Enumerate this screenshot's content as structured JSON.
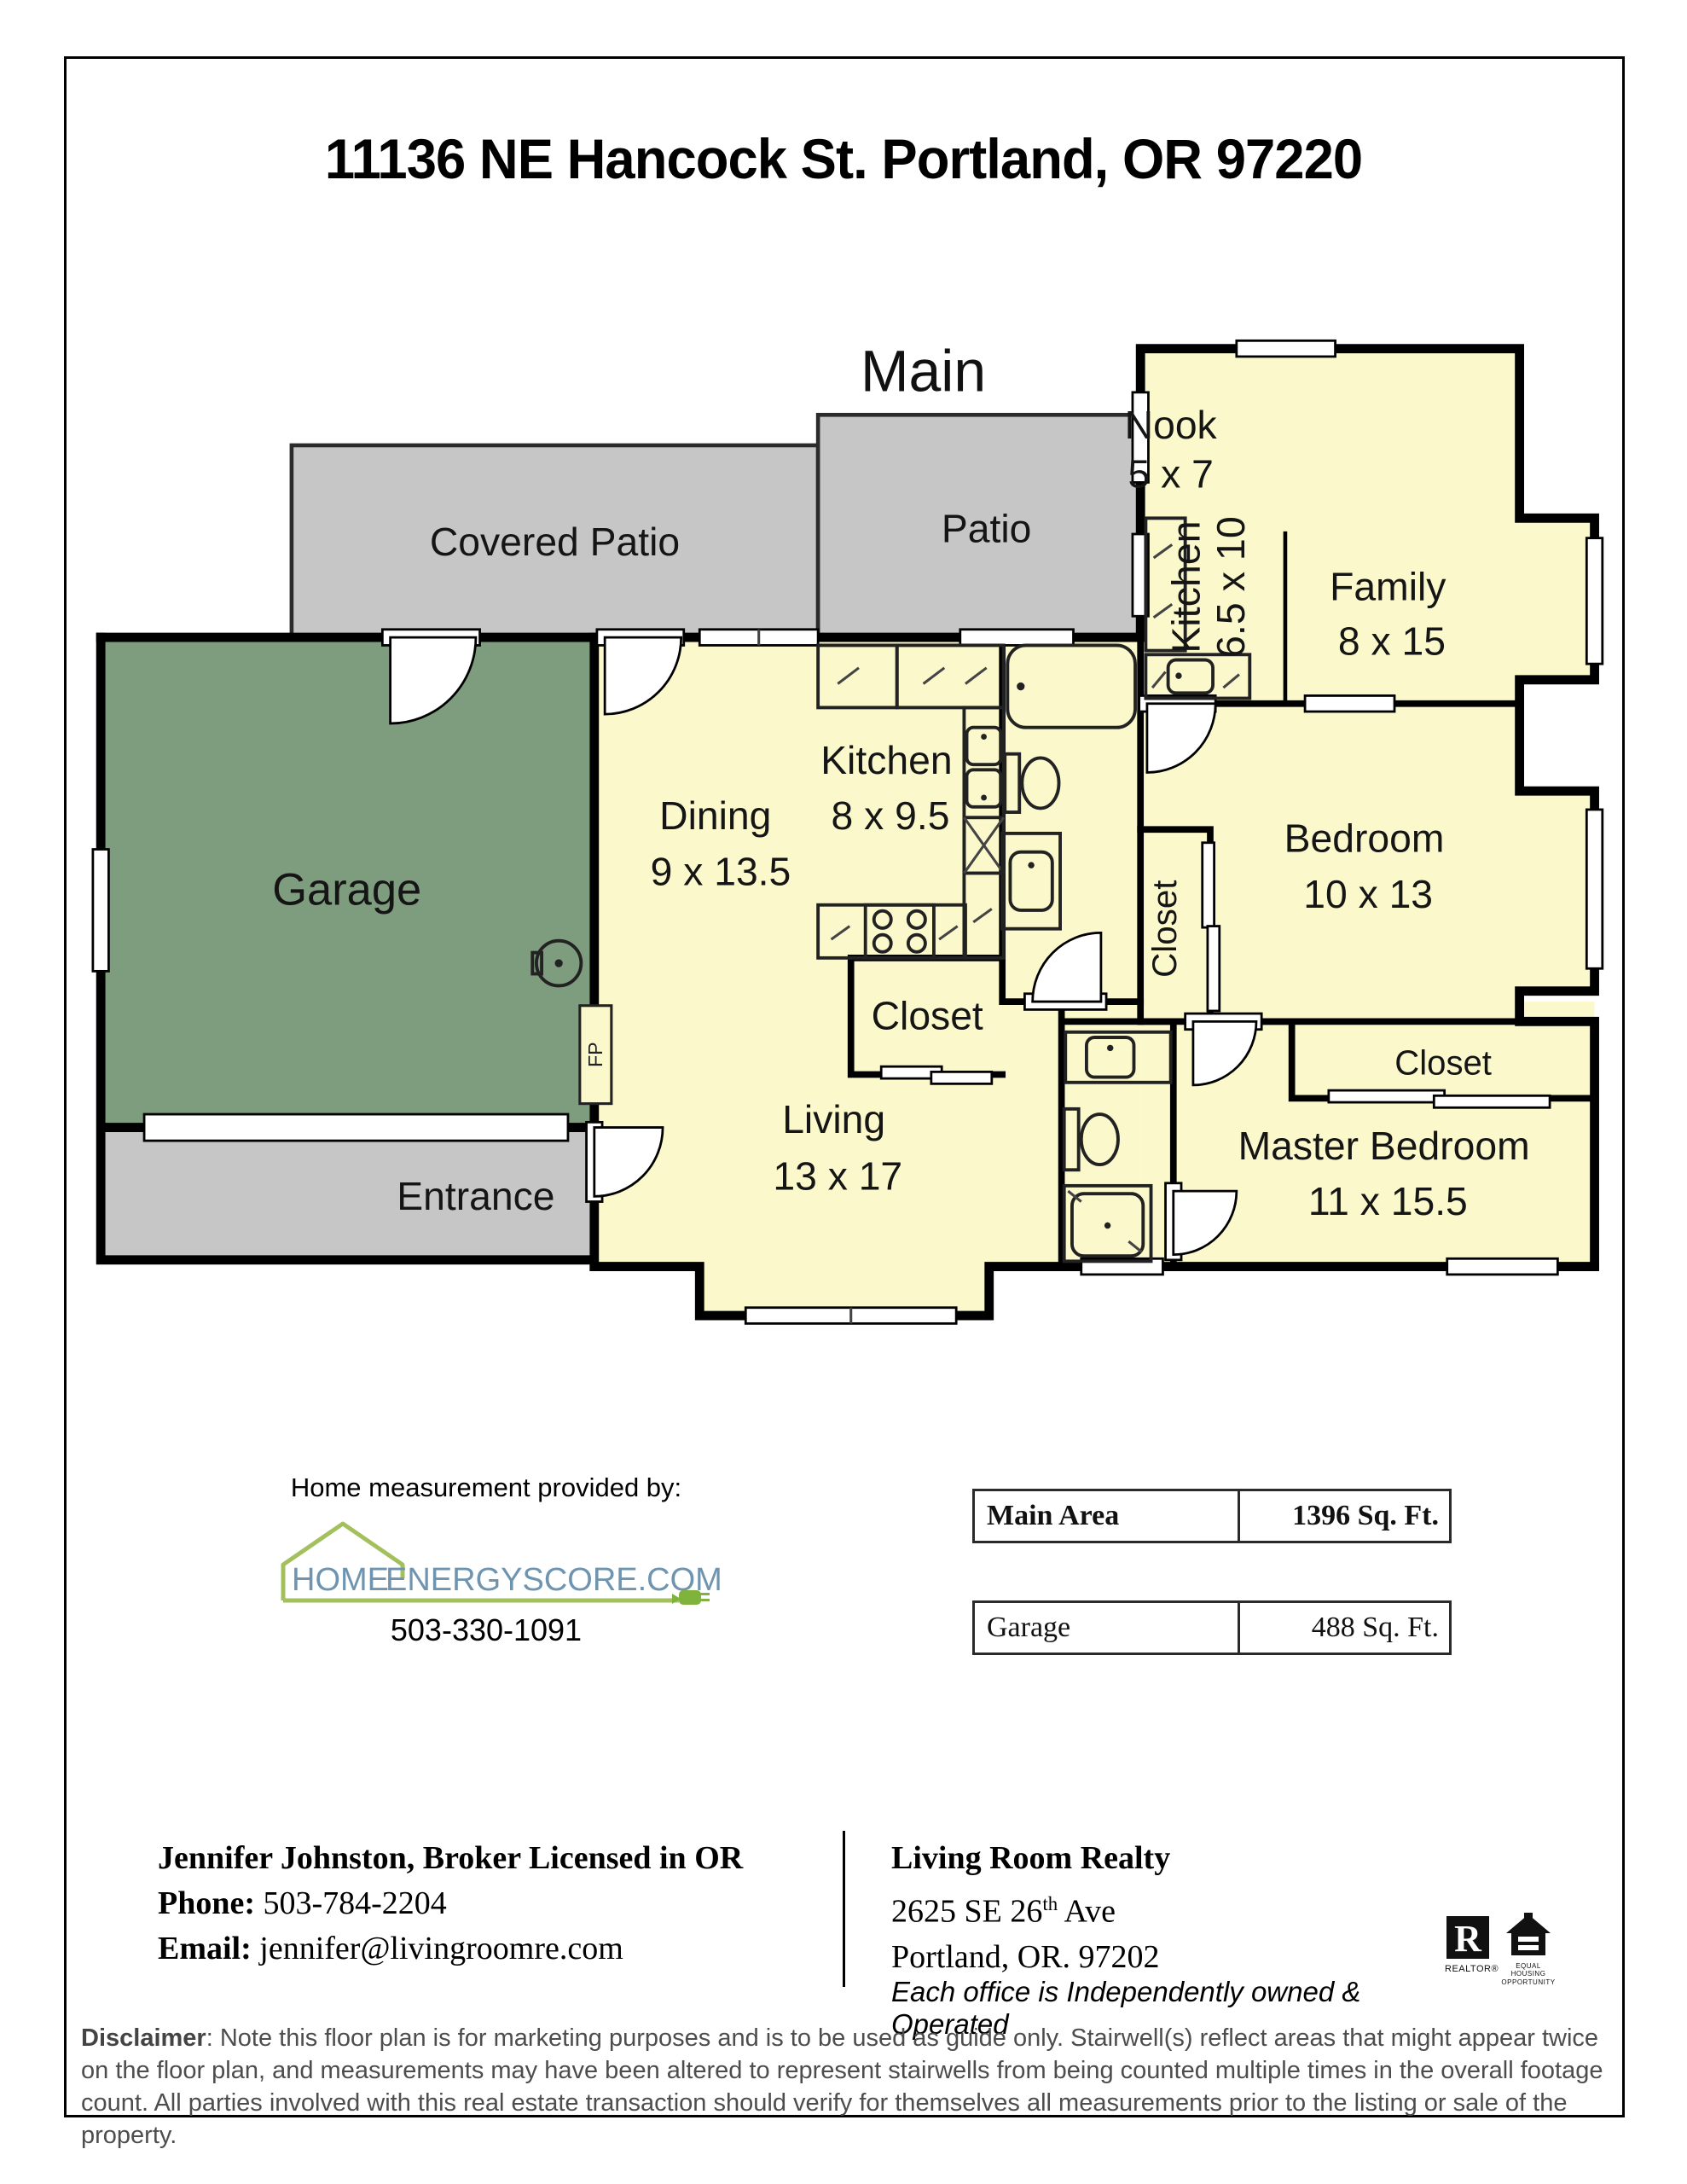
{
  "page": {
    "title": "11136 NE Hancock St. Portland, OR 97220"
  },
  "floorplan": {
    "level_label": "Main",
    "fp_label": "FP",
    "colors": {
      "room": "#FBF9CB",
      "garage": "#7E9C7E",
      "patio": "#C6C6C6",
      "wall": "#000000"
    },
    "rooms": {
      "covered_patio": {
        "name": "Covered Patio"
      },
      "patio": {
        "name": "Patio"
      },
      "nook": {
        "name": "Nook",
        "dims": "5 x 7"
      },
      "family": {
        "name": "Family",
        "dims": "8 x 15"
      },
      "kitchen_small": {
        "name": "Kitchen",
        "dims": "6.5 x 10"
      },
      "kitchen": {
        "name": "Kitchen",
        "dims": "8 x 9.5"
      },
      "dining": {
        "name": "Dining",
        "dims": "9 x 13.5"
      },
      "garage": {
        "name": "Garage"
      },
      "entrance": {
        "name": "Entrance"
      },
      "living": {
        "name": "Living",
        "dims": "13 x 17"
      },
      "bedroom": {
        "name": "Bedroom",
        "dims": "10 x 13"
      },
      "master": {
        "name": "Master Bedroom",
        "dims": "11 x 15.5"
      },
      "closet_kitchen": {
        "name": "Closet"
      },
      "closet_bedroom": {
        "name": "Closet"
      },
      "closet_master": {
        "name": "Closet"
      }
    }
  },
  "measurement": {
    "provided_by": "Home measurement provided by:",
    "logo_home": "HOME",
    "logo_rest": "ENERGYSCORE.COM",
    "phone": "503-330-1091"
  },
  "area_table": {
    "rows": [
      {
        "label": "Main Area",
        "value": "1396 Sq. Ft."
      },
      {
        "label": "Garage",
        "value": "488 Sq. Ft."
      }
    ]
  },
  "contact": {
    "broker_line": "Jennifer Johnston, Broker Licensed in OR",
    "phone_label": "Phone:",
    "phone": " 503-784-2204",
    "email_label": "Email:",
    "email": " jennifer@livingroomre.com",
    "office": "Living Room Realty",
    "address_line1_pre": "2625 SE 26",
    "address_sup": "th",
    "address_line1_post": " Ave",
    "address_line2": "Portland, OR. 97202",
    "tagline": "Each office is Independently owned & Operated",
    "realtor_caption": "REALTOR®",
    "eho_caption_1": "EQUAL HOUSING",
    "eho_caption_2": "OPPORTUNITY"
  },
  "disclaimer": {
    "label": "Disclaimer",
    "text": ": Note this floor plan is for marketing purposes and is to be used as guide only.  Stairwell(s) reflect areas that might appear twice on the floor plan, and measurements may have been altered to represent stairwells from being counted multiple times in the overall footage count.  All parties involved with this real estate transaction should verify for themselves all measurements prior to the listing or sale of the property."
  }
}
